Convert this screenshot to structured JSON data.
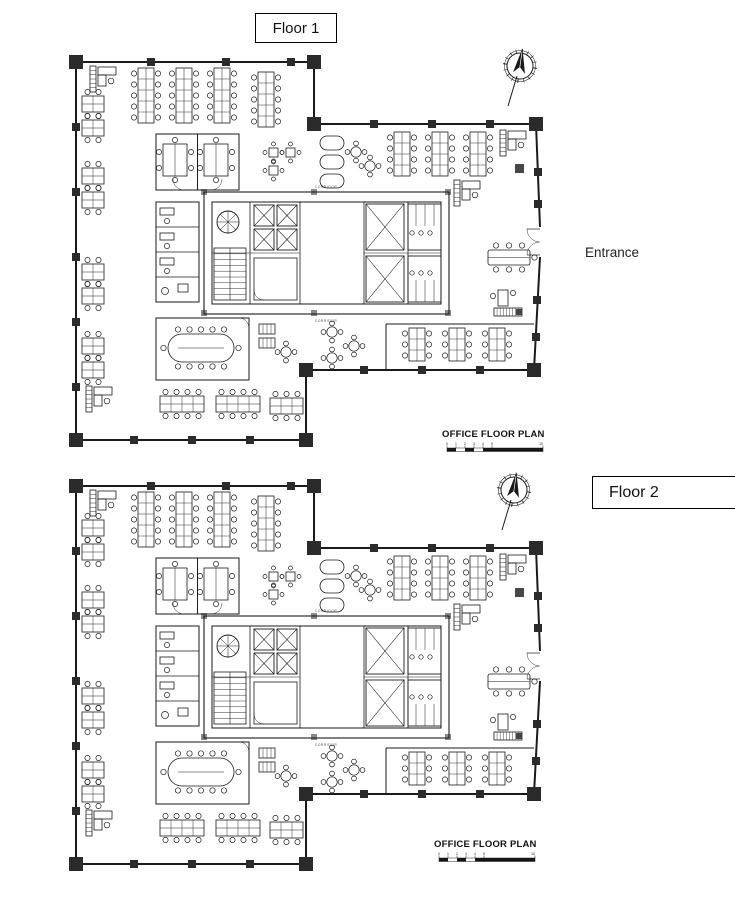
{
  "floor1": {
    "label": "Floor 1",
    "plan_title": "OFFICE FLOOR PLAN",
    "entrance_label": "Entrance",
    "corridor_label": "CORRIDOR",
    "compass_icon": "north-arrow-compass-icon"
  },
  "floor2": {
    "label": "Floor 2",
    "plan_title": "OFFICE FLOOR PLAN",
    "corridor_label": "CORRIDOR",
    "compass_icon": "north-arrow-compass-icon"
  },
  "scale_bar": {
    "tick_labels": [
      "0",
      "1",
      "2",
      "3",
      "4",
      "5",
      "10"
    ]
  },
  "colors": {
    "line": "#1a1a1a",
    "column_fill": "#2b2b2b",
    "background": "#ffffff",
    "text": "#1f1f1f",
    "corridor_text": "#555555"
  }
}
